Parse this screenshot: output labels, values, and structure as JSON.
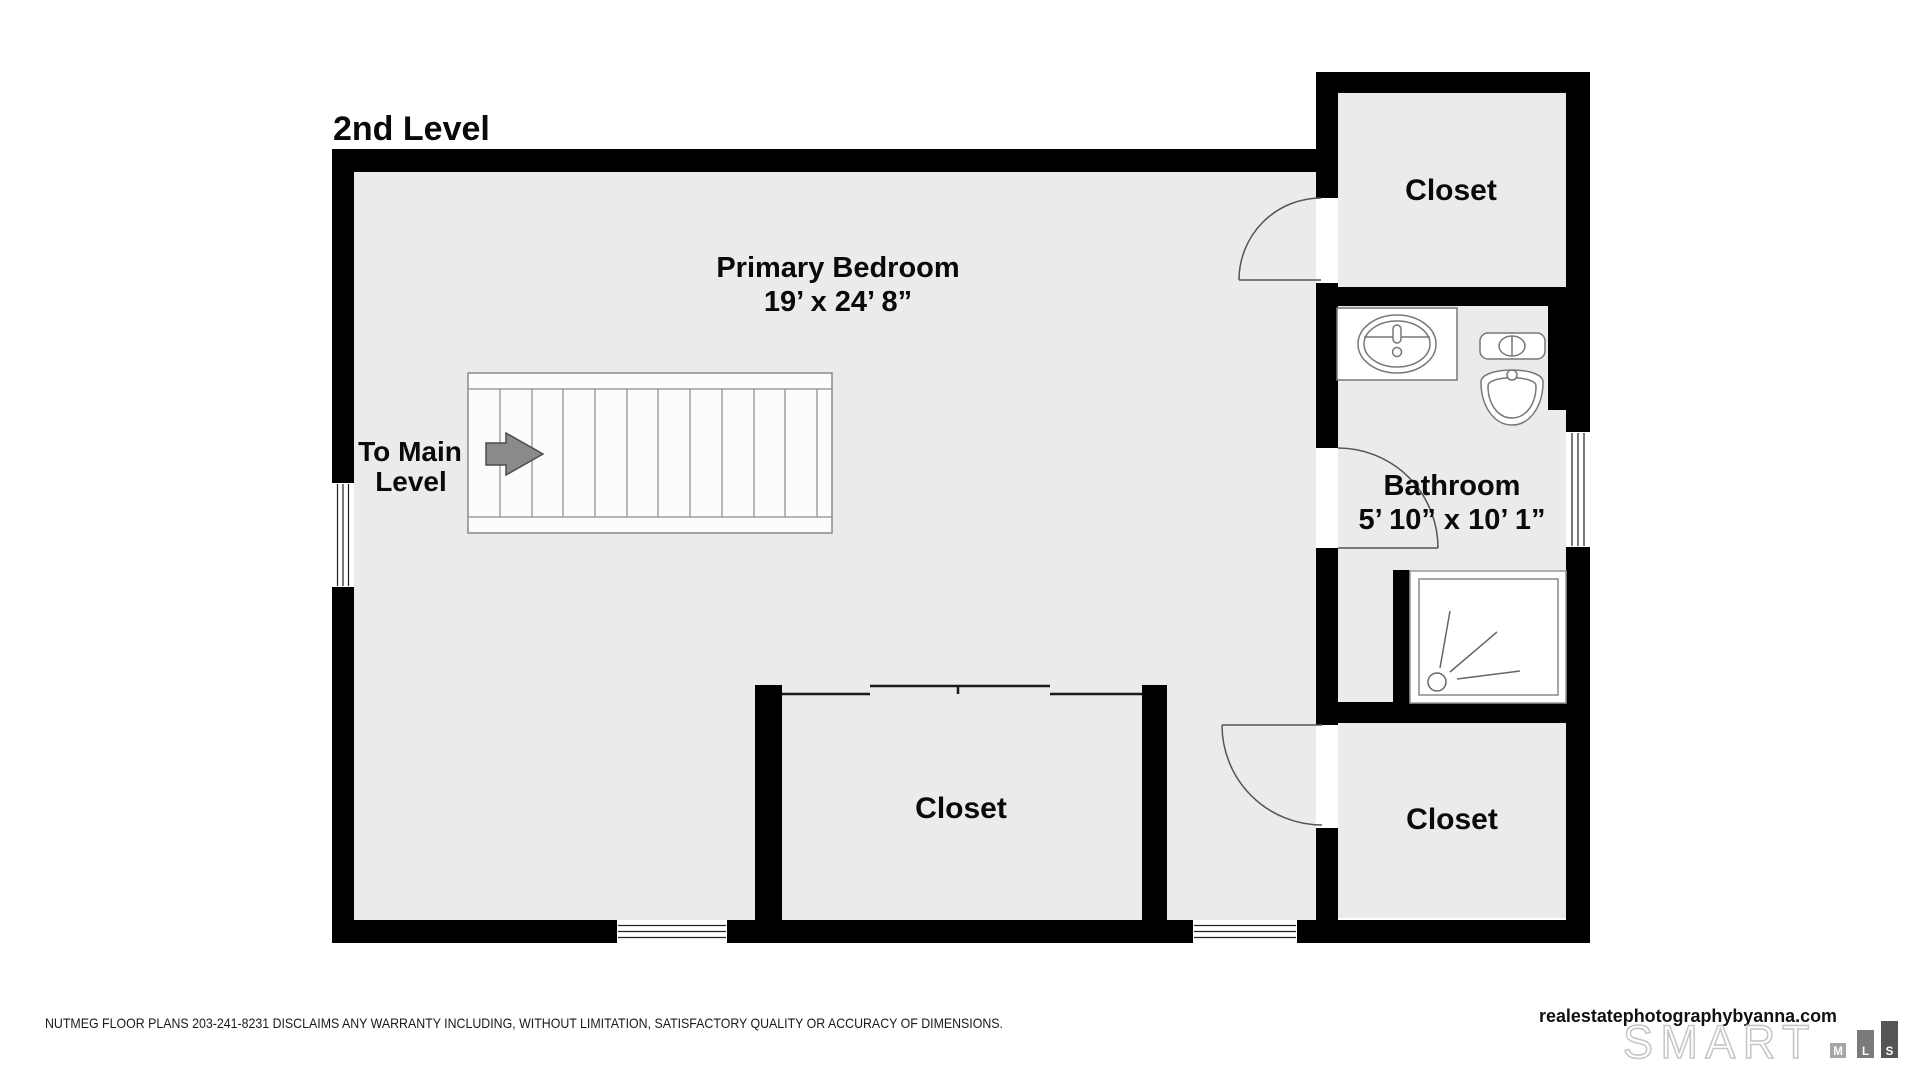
{
  "title": "2nd Level",
  "rooms": {
    "primary_bedroom": {
      "name": "Primary Bedroom",
      "dims": "19’ x 24’ 8”"
    },
    "closet_top_right": {
      "name": "Closet"
    },
    "bathroom": {
      "name": "Bathroom",
      "dims": "5’ 10” x 10’ 1”"
    },
    "closet_bottom_middle": {
      "name": "Closet"
    },
    "closet_bottom_right": {
      "name": "Closet"
    }
  },
  "stairs": {
    "label_line1": "To Main",
    "label_line2": "Level"
  },
  "footer": {
    "disclaimer": "NUTMEG FLOOR PLANS 203-241-8231 DISCLAIMS ANY WARRANTY INCLUDING, WITHOUT LIMITATION, SATISFACTORY QUALITY OR ACCURACY OF DIMENSIONS.",
    "website": "realestatephotographybyanna.com",
    "logo_word": "SMART",
    "logo_blocks": [
      "M",
      "L",
      "S"
    ]
  },
  "colors": {
    "floor": "#ebebeb",
    "wall": "#000000",
    "arrow": "#8a8a8a",
    "logo_outline": "#c6c6c6",
    "mls_m_block": "#a6a6a6",
    "mls_l_block": "#7a7a7a",
    "mls_s_block": "#555555"
  }
}
